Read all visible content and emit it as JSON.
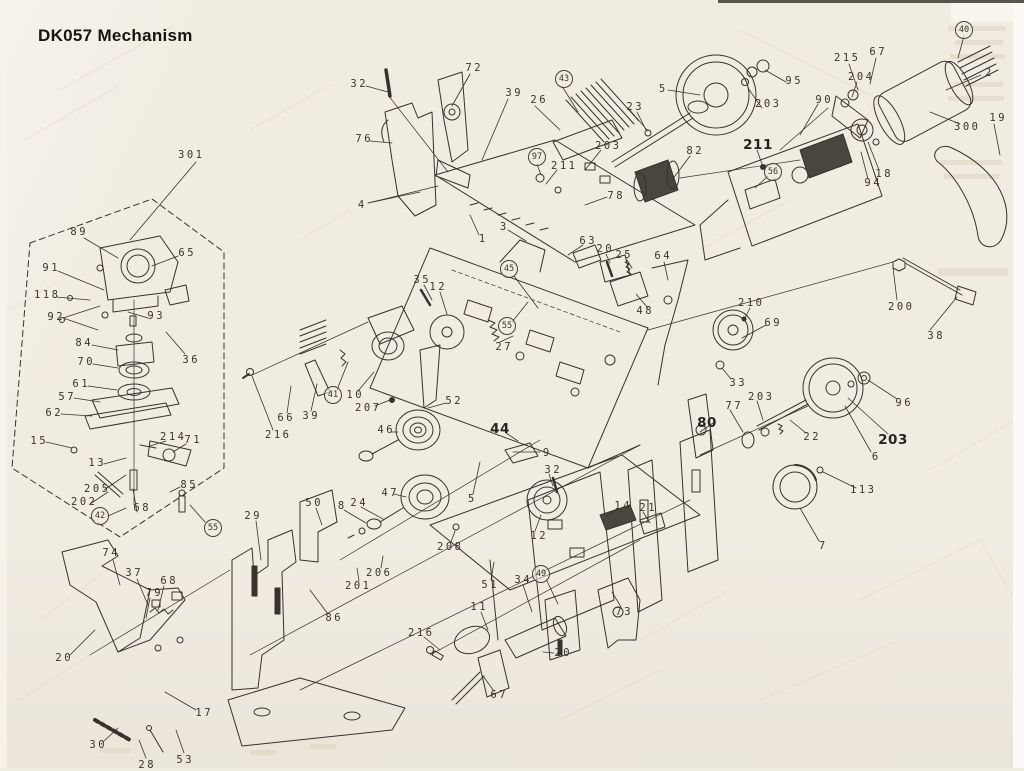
{
  "title": "DK057 Mechanism",
  "diagram": {
    "type": "exploded-parts-diagram",
    "subject": "Cassette tape deck mechanism DK057, exploded view with numbered part callouts",
    "colors": {
      "paper": "#f1ece1",
      "ink": "#37332c",
      "label_ink": "#3a352d"
    },
    "labels": [
      {
        "text": "301",
        "x": 190,
        "y": 155
      },
      {
        "text": "89",
        "x": 78,
        "y": 232
      },
      {
        "text": "65",
        "x": 186,
        "y": 253
      },
      {
        "text": "91",
        "x": 50,
        "y": 268
      },
      {
        "text": "118",
        "x": 46,
        "y": 295
      },
      {
        "text": "92",
        "x": 55,
        "y": 317
      },
      {
        "text": "93",
        "x": 155,
        "y": 316
      },
      {
        "text": "84",
        "x": 83,
        "y": 343
      },
      {
        "text": "36",
        "x": 190,
        "y": 360
      },
      {
        "text": "70",
        "x": 85,
        "y": 362
      },
      {
        "text": "61",
        "x": 80,
        "y": 384
      },
      {
        "text": "57",
        "x": 66,
        "y": 397
      },
      {
        "text": "62",
        "x": 53,
        "y": 413
      },
      {
        "text": "15",
        "x": 38,
        "y": 441
      },
      {
        "text": "214",
        "x": 172,
        "y": 437
      },
      {
        "text": "71",
        "x": 192,
        "y": 440
      },
      {
        "text": "13",
        "x": 96,
        "y": 463
      },
      {
        "text": "205",
        "x": 96,
        "y": 489
      },
      {
        "text": "85",
        "x": 188,
        "y": 485
      },
      {
        "text": "202",
        "x": 83,
        "y": 502
      },
      {
        "text": "68",
        "x": 141,
        "y": 508
      },
      {
        "text": "42",
        "x": 100,
        "y": 516,
        "circled": true
      },
      {
        "text": "55",
        "x": 213,
        "y": 528,
        "circled": true
      },
      {
        "text": "74",
        "x": 110,
        "y": 553
      },
      {
        "text": "37",
        "x": 133,
        "y": 573
      },
      {
        "text": "68",
        "x": 168,
        "y": 581
      },
      {
        "text": "79",
        "x": 153,
        "y": 593
      },
      {
        "text": "20",
        "x": 63,
        "y": 658
      },
      {
        "text": "17",
        "x": 203,
        "y": 713
      },
      {
        "text": "30",
        "x": 97,
        "y": 745
      },
      {
        "text": "28",
        "x": 146,
        "y": 765
      },
      {
        "text": "53",
        "x": 184,
        "y": 760
      },
      {
        "text": "86",
        "x": 333,
        "y": 618
      },
      {
        "text": "32",
        "x": 358,
        "y": 84
      },
      {
        "text": "72",
        "x": 473,
        "y": 68
      },
      {
        "text": "76",
        "x": 363,
        "y": 139
      },
      {
        "text": "39",
        "x": 513,
        "y": 93
      },
      {
        "text": "26",
        "x": 538,
        "y": 100
      },
      {
        "text": "43",
        "x": 564,
        "y": 79,
        "circled": true
      },
      {
        "text": "203",
        "x": 607,
        "y": 146
      },
      {
        "text": "97",
        "x": 537,
        "y": 157,
        "circled": true
      },
      {
        "text": "211",
        "x": 563,
        "y": 166
      },
      {
        "text": "78",
        "x": 615,
        "y": 196
      },
      {
        "text": "4",
        "x": 361,
        "y": 205
      },
      {
        "text": "1",
        "x": 482,
        "y": 239
      },
      {
        "text": "3",
        "x": 503,
        "y": 227
      },
      {
        "text": "63",
        "x": 587,
        "y": 241
      },
      {
        "text": "5",
        "x": 662,
        "y": 89
      },
      {
        "text": "95",
        "x": 793,
        "y": 81
      },
      {
        "text": "203",
        "x": 767,
        "y": 104
      },
      {
        "text": "90",
        "x": 823,
        "y": 100
      },
      {
        "text": "23",
        "x": 634,
        "y": 107
      },
      {
        "text": "82",
        "x": 694,
        "y": 151
      },
      {
        "text": "211",
        "x": 758,
        "y": 145,
        "bold": true
      },
      {
        "text": "56",
        "x": 773,
        "y": 172,
        "circled": true
      },
      {
        "text": "215",
        "x": 846,
        "y": 58
      },
      {
        "text": "67",
        "x": 877,
        "y": 52
      },
      {
        "text": "204",
        "x": 860,
        "y": 77
      },
      {
        "text": "40",
        "x": 964,
        "y": 30,
        "circled": true
      },
      {
        "text": "2",
        "x": 988,
        "y": 73
      },
      {
        "text": "300",
        "x": 966,
        "y": 127
      },
      {
        "text": "19",
        "x": 997,
        "y": 118
      },
      {
        "text": "18",
        "x": 883,
        "y": 174
      },
      {
        "text": "94",
        "x": 872,
        "y": 183
      },
      {
        "text": "200",
        "x": 900,
        "y": 307
      },
      {
        "text": "38",
        "x": 935,
        "y": 336
      },
      {
        "text": "210",
        "x": 750,
        "y": 303
      },
      {
        "text": "69",
        "x": 772,
        "y": 323
      },
      {
        "text": "33",
        "x": 737,
        "y": 383
      },
      {
        "text": "96",
        "x": 903,
        "y": 403
      },
      {
        "text": "203",
        "x": 893,
        "y": 440,
        "bold": true
      },
      {
        "text": "203",
        "x": 760,
        "y": 397
      },
      {
        "text": "22",
        "x": 811,
        "y": 437
      },
      {
        "text": "77",
        "x": 733,
        "y": 406
      },
      {
        "text": "80",
        "x": 707,
        "y": 423,
        "bold": true
      },
      {
        "text": "6",
        "x": 875,
        "y": 457
      },
      {
        "text": "113",
        "x": 862,
        "y": 490
      },
      {
        "text": "7",
        "x": 822,
        "y": 546
      },
      {
        "text": "35",
        "x": 421,
        "y": 280
      },
      {
        "text": "12",
        "x": 437,
        "y": 287
      },
      {
        "text": "27",
        "x": 503,
        "y": 347
      },
      {
        "text": "45",
        "x": 509,
        "y": 269,
        "circled": true
      },
      {
        "text": "55",
        "x": 507,
        "y": 326,
        "circled": true
      },
      {
        "text": "41",
        "x": 333,
        "y": 395,
        "circled": true
      },
      {
        "text": "10",
        "x": 354,
        "y": 395
      },
      {
        "text": "207",
        "x": 367,
        "y": 408
      },
      {
        "text": "52",
        "x": 453,
        "y": 401
      },
      {
        "text": "39",
        "x": 310,
        "y": 416
      },
      {
        "text": "66",
        "x": 285,
        "y": 418
      },
      {
        "text": "216",
        "x": 277,
        "y": 435
      },
      {
        "text": "46",
        "x": 385,
        "y": 430
      },
      {
        "text": "44",
        "x": 500,
        "y": 429,
        "bold": true
      },
      {
        "text": "20",
        "x": 604,
        "y": 249
      },
      {
        "text": "25",
        "x": 623,
        "y": 255
      },
      {
        "text": "64",
        "x": 662,
        "y": 256
      },
      {
        "text": "48",
        "x": 644,
        "y": 311
      },
      {
        "text": "9",
        "x": 546,
        "y": 453
      },
      {
        "text": "32",
        "x": 552,
        "y": 470
      },
      {
        "text": "47",
        "x": 389,
        "y": 493
      },
      {
        "text": "5",
        "x": 471,
        "y": 499
      },
      {
        "text": "12",
        "x": 538,
        "y": 536
      },
      {
        "text": "14",
        "x": 622,
        "y": 506
      },
      {
        "text": "21",
        "x": 647,
        "y": 508
      },
      {
        "text": "208",
        "x": 449,
        "y": 547
      },
      {
        "text": "206",
        "x": 378,
        "y": 573
      },
      {
        "text": "201",
        "x": 357,
        "y": 586
      },
      {
        "text": "29",
        "x": 252,
        "y": 516
      },
      {
        "text": "50",
        "x": 313,
        "y": 503
      },
      {
        "text": "8",
        "x": 341,
        "y": 506
      },
      {
        "text": "24",
        "x": 358,
        "y": 503
      },
      {
        "text": "51",
        "x": 489,
        "y": 585
      },
      {
        "text": "34",
        "x": 522,
        "y": 580
      },
      {
        "text": "49",
        "x": 541,
        "y": 574,
        "circled": true
      },
      {
        "text": "73",
        "x": 623,
        "y": 612
      },
      {
        "text": "11",
        "x": 478,
        "y": 607
      },
      {
        "text": "216",
        "x": 420,
        "y": 633
      },
      {
        "text": "20",
        "x": 562,
        "y": 653
      },
      {
        "text": "67",
        "x": 498,
        "y": 695
      }
    ]
  }
}
